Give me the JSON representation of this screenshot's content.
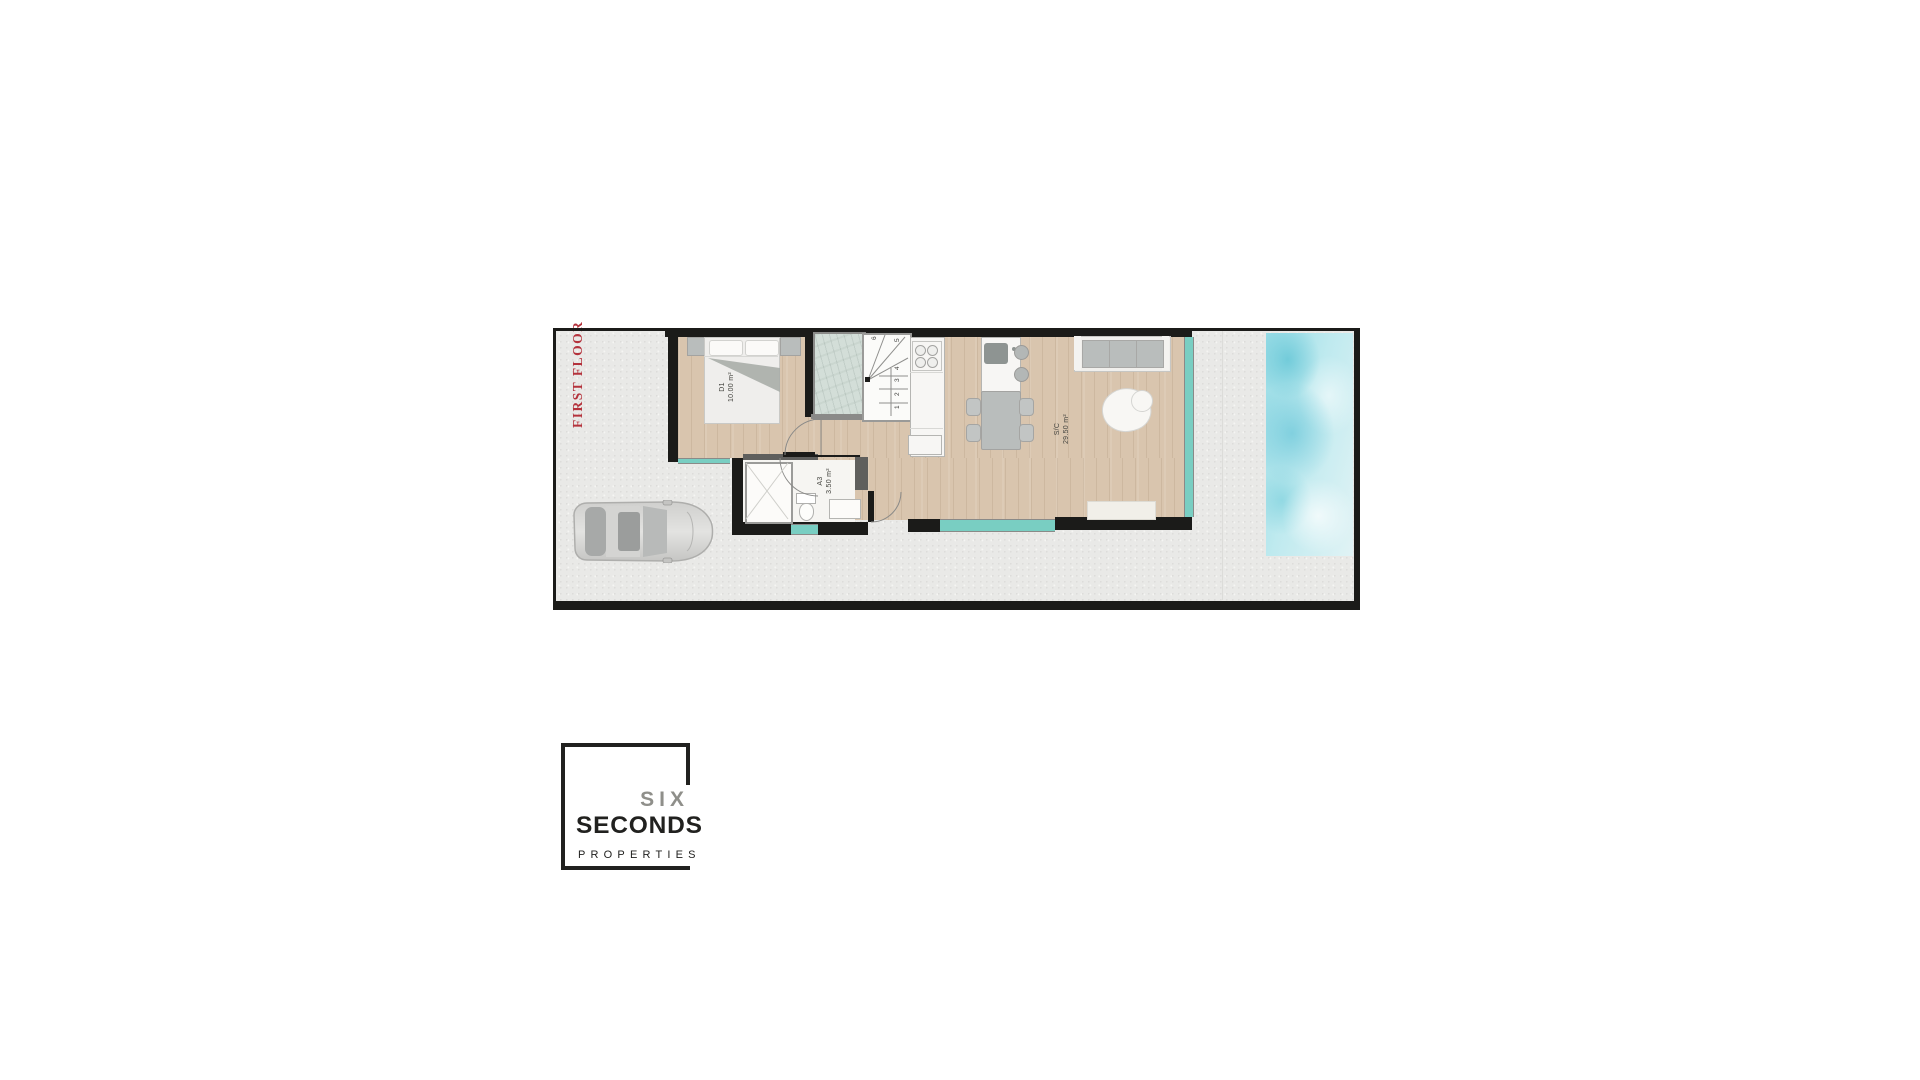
{
  "plan": {
    "floor_label": "FIRST FLOOR",
    "rooms": [
      {
        "name": "bedroom",
        "code": "D1",
        "area": "10.00 m²"
      },
      {
        "name": "bathroom",
        "code": "A3",
        "area": "3.50 m²"
      },
      {
        "name": "living-kitchen",
        "code": "S/C",
        "area": "29.50 m²"
      }
    ],
    "stairs_steps": [
      "1",
      "2",
      "3",
      "4",
      "5",
      "6"
    ],
    "colors": {
      "accent": "#b4323c",
      "wall": "#1b1b19",
      "partition": "#5f5f5d",
      "wood_floor": "#d9c5ae",
      "concrete": "#e9e9e7",
      "window_glass": "#79cec2",
      "pool_deep": "#65c6d6",
      "pool_light": "#e1f3f5",
      "furniture_gray": "#b9bdbc",
      "furniture_white": "#f2f1ee",
      "label_text": "#44443f"
    }
  },
  "logo": {
    "line1": "SIX",
    "line2": "SECONDS",
    "line3": "PROPERTIES",
    "colors": {
      "logo_border": "#21211f",
      "logo_text": "#21211f",
      "logo_six": "#8f8f8a"
    }
  }
}
